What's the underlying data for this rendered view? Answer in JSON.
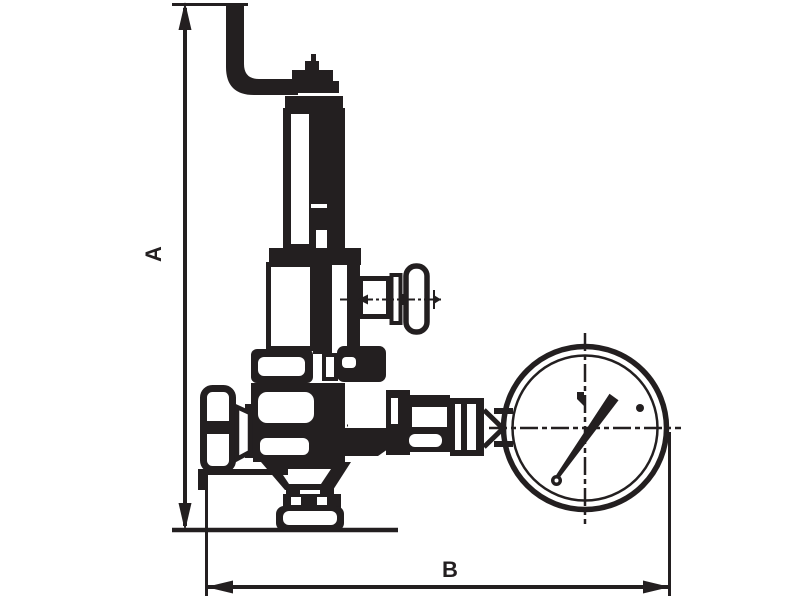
{
  "diagram": {
    "type": "technical-line-drawing",
    "subject": "pressure reducing valve with lever, handwheel and pressure gauge",
    "ink_color": "#231f20",
    "background_color": "#ffffff",
    "dimension_labels": {
      "vertical": "A",
      "horizontal": "B"
    },
    "components": [
      "lever-handle",
      "adjusting-cap",
      "spring-bonnet",
      "tee-valve-with-t-handle",
      "inlet-handwheel",
      "valve-body",
      "outlet-flange",
      "gauge-connection-fitting",
      "pressure-gauge"
    ]
  }
}
